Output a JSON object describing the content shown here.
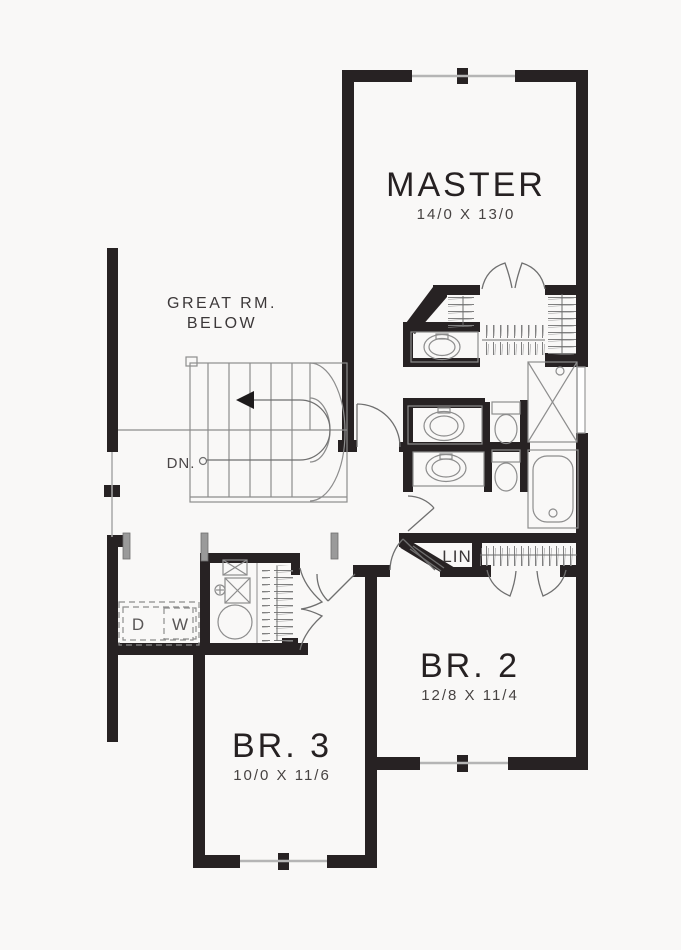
{
  "plan": {
    "type": "second-floor-plan",
    "colors": {
      "wall": "#272223",
      "background": "#f9f8f7",
      "thin_line": "#8d8d8d",
      "glass": "#b5b5b5",
      "text": "#2e2a2b"
    },
    "rooms": {
      "master": {
        "name": "MASTER",
        "dims": "14/0 X 13/0"
      },
      "great_room": {
        "line1": "GREAT RM.",
        "line2": "BELOW"
      },
      "br2": {
        "name": "BR. 2",
        "dims": "12/8 X 11/4"
      },
      "br3": {
        "name": "BR. 3",
        "dims": "10/0 X 11/6"
      },
      "linen": {
        "name": "LIN"
      },
      "stairs": {
        "down_label": "DN."
      },
      "laundry": {
        "dryer": "D",
        "washer": "W"
      }
    }
  }
}
